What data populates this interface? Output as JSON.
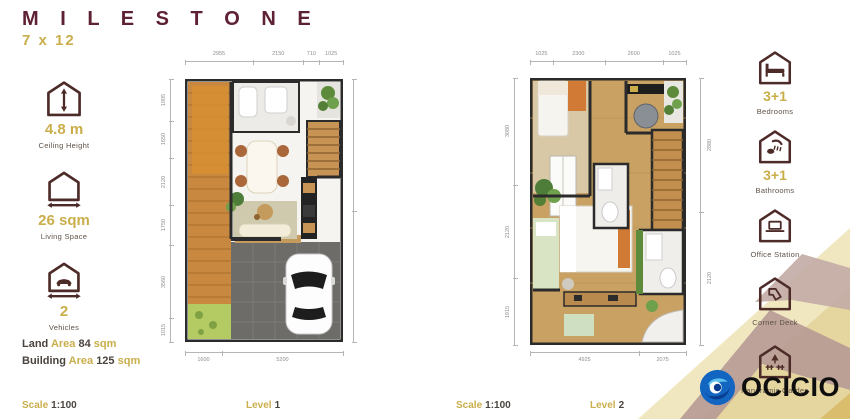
{
  "header": {
    "title": "M I L E S T O N E",
    "size": "7 x 12"
  },
  "specs": [
    {
      "icon": "ceiling-height-icon",
      "value": "4.8 m",
      "label": "Ceiling Height"
    },
    {
      "icon": "living-space-icon",
      "value": "26 sqm",
      "label": "Living Space"
    },
    {
      "icon": "vehicles-icon",
      "value": "2",
      "label": "Vehicles"
    }
  ],
  "areas": [
    {
      "prefix": "Land",
      "mid": "Area",
      "value": "84",
      "suffix": "sqm"
    },
    {
      "prefix": "Building",
      "mid": "Area",
      "value": "125",
      "suffix": "sqm"
    }
  ],
  "amenities": [
    {
      "icon": "bedrooms-icon",
      "value": "3+1",
      "label": "Bedrooms"
    },
    {
      "icon": "bathrooms-icon",
      "value": "3+1",
      "label": "Bathrooms"
    },
    {
      "icon": "office-station-icon",
      "value": "",
      "label": "Office Station"
    },
    {
      "icon": "corner-deck-icon",
      "value": "",
      "label": "Corner Deck"
    },
    {
      "icon": "panoramic-garden-icon",
      "value": "",
      "label": "Panoramic Garden"
    }
  ],
  "footer": {
    "scale_label": "Scale",
    "scale_value": "1:100",
    "level1_label": "Level",
    "level1_value": "1",
    "level2_label": "Level",
    "level2_value": "2"
  },
  "plans": {
    "level1": {
      "name": "Level 1",
      "top_dims": [
        "2955",
        "2150",
        "710",
        "1025"
      ],
      "bottom_dims": [
        "1600",
        "5200"
      ],
      "left_dims": [
        "1905",
        "1650",
        "2120",
        "1750",
        "3560",
        "1015"
      ]
    },
    "level2": {
      "name": "Level 2",
      "top_dims": [
        "1025",
        "2300",
        "2600",
        "1025"
      ],
      "bottom_dims": [
        "4925",
        "2075"
      ],
      "left_dims": [
        "3080",
        "2120",
        "1915"
      ],
      "right_dims": [
        "2880",
        "2120"
      ]
    }
  },
  "logo": {
    "text": "OCICIO"
  },
  "colors": {
    "maroon": "#5e2133",
    "gold": "#c9ae4b",
    "icon_stroke": "#4c2b28",
    "logo_blue": "#1266c2",
    "wall": "#2b2b2b"
  }
}
